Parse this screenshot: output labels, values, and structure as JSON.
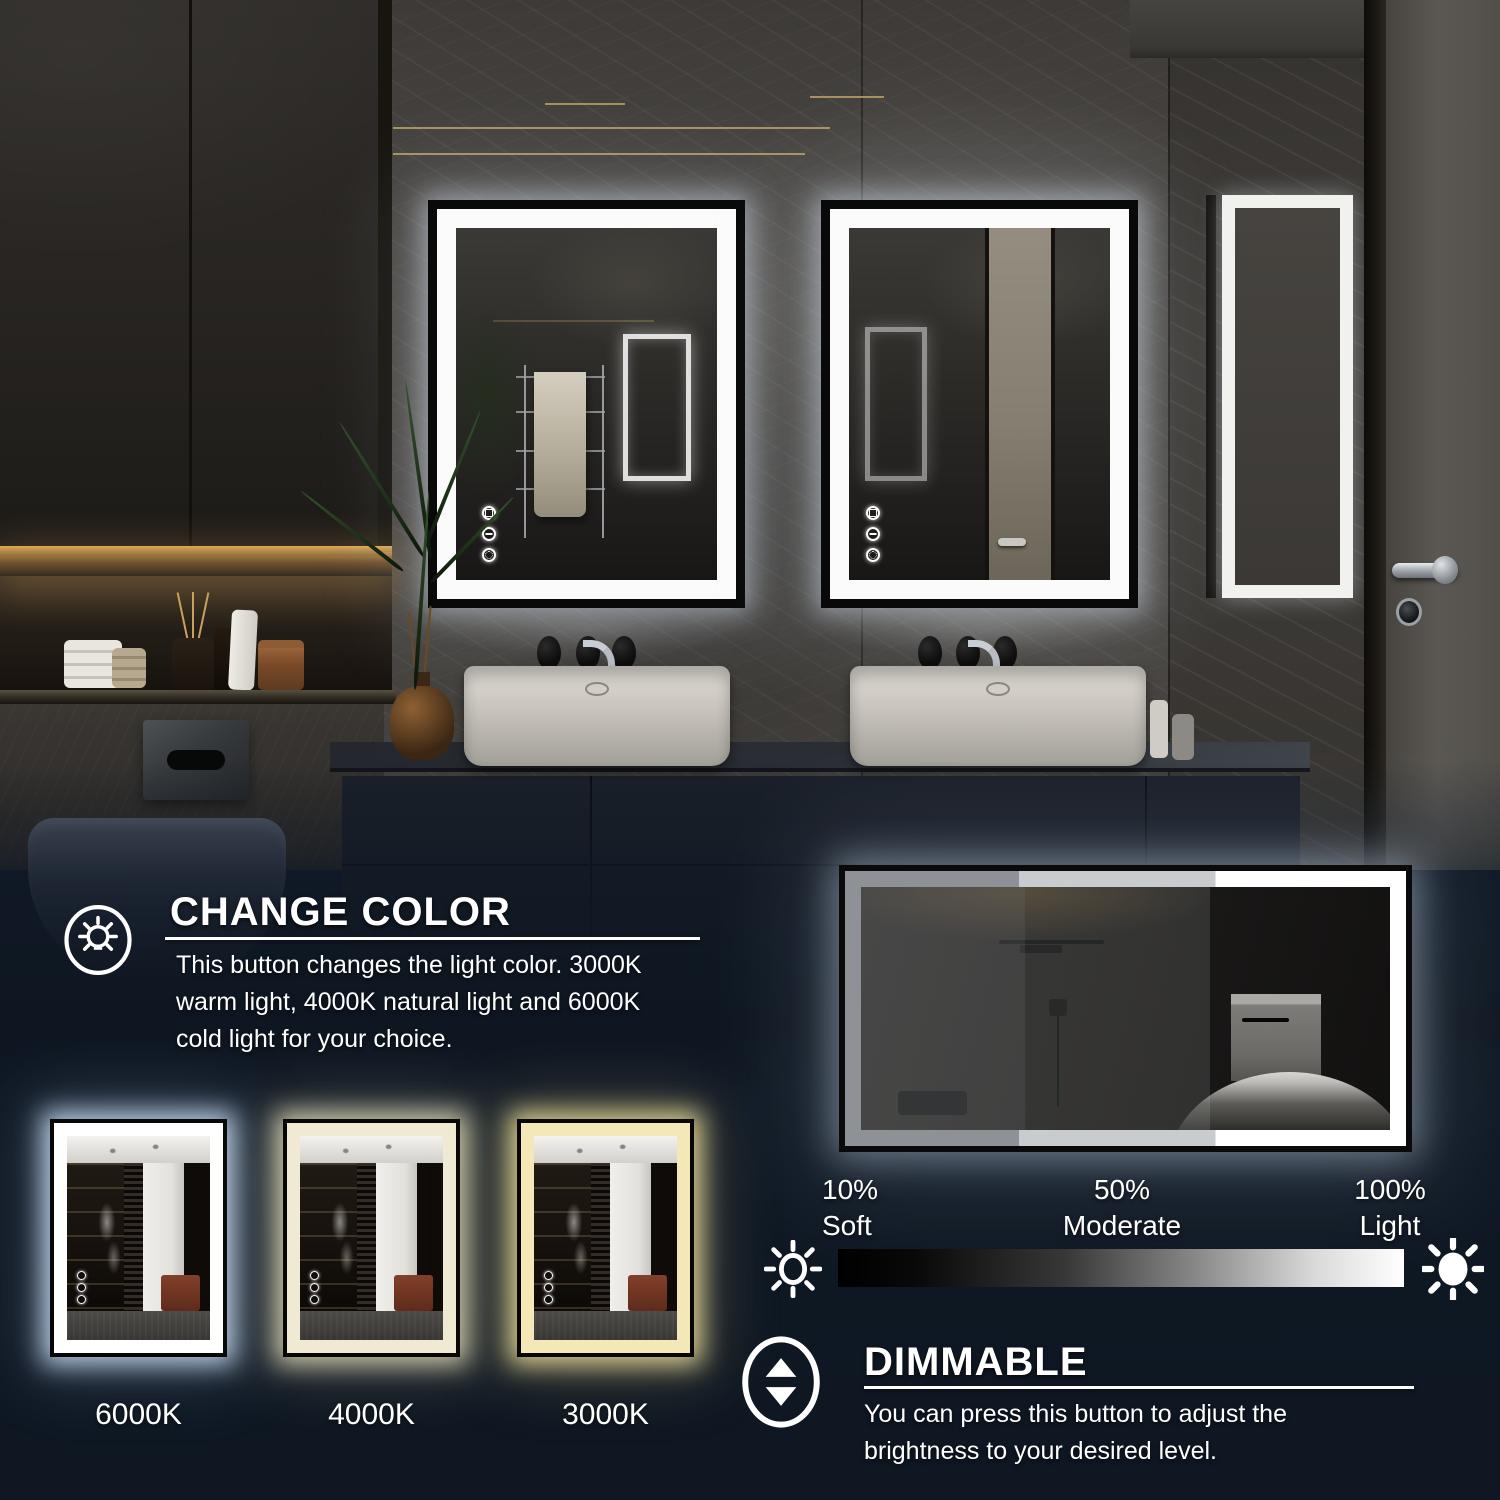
{
  "sections": {
    "change_color": {
      "icon": "lightbulb-icon",
      "title": "CHANGE COLOR",
      "description": "This button changes the light color. 3000K warm light, 4000K natural light and 6000K cold light for your choice."
    },
    "dimmable": {
      "icon": "brightness-adjust-icon",
      "title": "DIMMABLE",
      "description": "You can press this button to adjust the brightness to your desired level."
    }
  },
  "color_temperatures": [
    {
      "label": "6000K",
      "led_color": "#ffffff"
    },
    {
      "label": "4000K",
      "led_color": "#f0ead4"
    },
    {
      "label": "3000K",
      "led_color": "#f4e8b9"
    }
  ],
  "brightness_levels": [
    {
      "percent": "10%",
      "label": "Soft"
    },
    {
      "percent": "50%",
      "label": "Moderate"
    },
    {
      "percent": "100%",
      "label": "Light"
    }
  ],
  "icons": {
    "scale_left": "sun-outline-icon",
    "scale_right": "sun-filled-icon",
    "mirror_buttons": "touch-control-icons"
  },
  "colors": {
    "overlay_panel": "#0f1824",
    "led_cool": "#ffffff",
    "led_natural": "#f0ead4",
    "led_warm": "#f4e8b9",
    "scale_start": "#000000",
    "scale_end": "#ffffff",
    "gold_inlay": "#b49a64"
  }
}
